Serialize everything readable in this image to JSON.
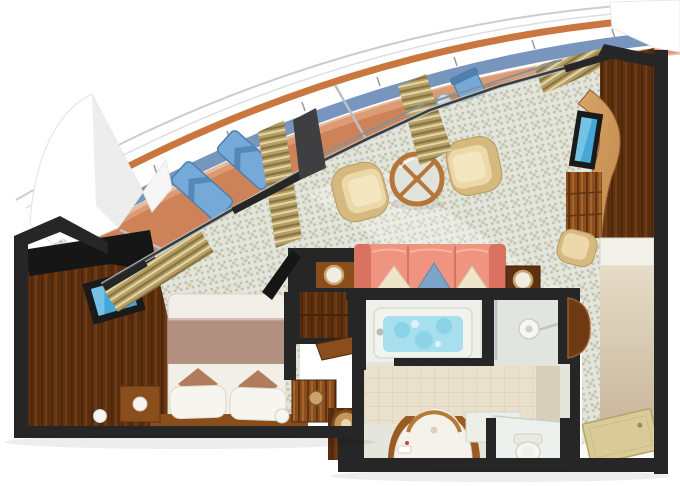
{
  "figure": {
    "alt": "Aerial 3D cutaway floor plan of a cruise ship balcony stateroom",
    "type": "floor-plan"
  },
  "rooms": [
    {
      "id": "balcony",
      "features": [
        "curved-railing",
        "deck-lounger",
        "deck-lounger",
        "deck-chair",
        "glass-partition"
      ]
    },
    {
      "id": "living-room",
      "features": [
        "armchair",
        "armchair",
        "coffee-table",
        "sofa",
        "tv",
        "desk",
        "desk-chair",
        "curtains"
      ]
    },
    {
      "id": "bedroom",
      "features": [
        "double-bed",
        "wardrobe",
        "tv",
        "nightstand",
        "lamp",
        "open-closet",
        "stool",
        "curtains"
      ]
    },
    {
      "id": "bathroom",
      "features": [
        "bathtub",
        "shower",
        "vanity-sink",
        "toilet"
      ]
    },
    {
      "id": "entry-hall",
      "features": [
        "entry-door",
        "closet"
      ]
    }
  ],
  "palette": {
    "wall": "#262626",
    "wallDark": "#161616",
    "hullLine": "#cccccc",
    "railLine": "#dedede",
    "railingOrange": "#c9773f",
    "bandBlue": "#7795bd",
    "balconyFloor": "#cd8257",
    "balconyFloorLight": "#e0a37c",
    "loungerBlue": "#74a9d8",
    "loungerBlueDark": "#4f80ad",
    "glassFrame": "#b9c2c6",
    "glassDark": "#3c3c3c",
    "carpetBase": "#e4e5da",
    "carpetDot": "#b7c1b1",
    "carpetDot2": "#cfc6ab",
    "woodDark": "#5e3110",
    "woodGrainDark": "#4a2408",
    "woodGrainLight": "#7a431a",
    "woodMid": "#8a4d1c",
    "woodLight": "#b5763a",
    "deskWood": "#c08a4a",
    "curtainBase": "#b59f66",
    "curtainDark": "#8a7443",
    "curtainLight": "#e3d6a6",
    "sofaCoral": "#ef9480",
    "sofaCoralDark": "#d97260",
    "pillowCream": "#efe3c8",
    "pillowBlue": "#7da4c8",
    "chairCream": "#ecd8a8",
    "chairCreamDark": "#d6b97f",
    "chairCreamLight": "#f4e6bf",
    "bedWhite": "#f2efe8",
    "bedBand": "#b29180",
    "cushionBrown": "#b07c5c",
    "lampWhite": "#f7f5ef",
    "bathWall": "#e4e5db",
    "bathRoomLight": "#eff0e9",
    "tileFloor": "#eae1cc",
    "tileLine": "#d9cdb0",
    "tubWhite": "#f3f3ee",
    "waterBlue": "#a8dfee",
    "waterBlueDark": "#6cc6dc",
    "toiletWhite": "#f6f7f4",
    "entryWallTop": "#e6dcc8",
    "entryWallBottom": "#c3b093",
    "doorTan": "#d9cb97",
    "doorTanEdge": "#b3a469",
    "floorWhite": "#fafaf7",
    "tvFrame": "#1a1a1a",
    "tvScreen": "#45a8d8",
    "tvScreenLight": "#a8dcef",
    "towelWhite": "#f2ede2",
    "towelRing": "#caa36a"
  }
}
